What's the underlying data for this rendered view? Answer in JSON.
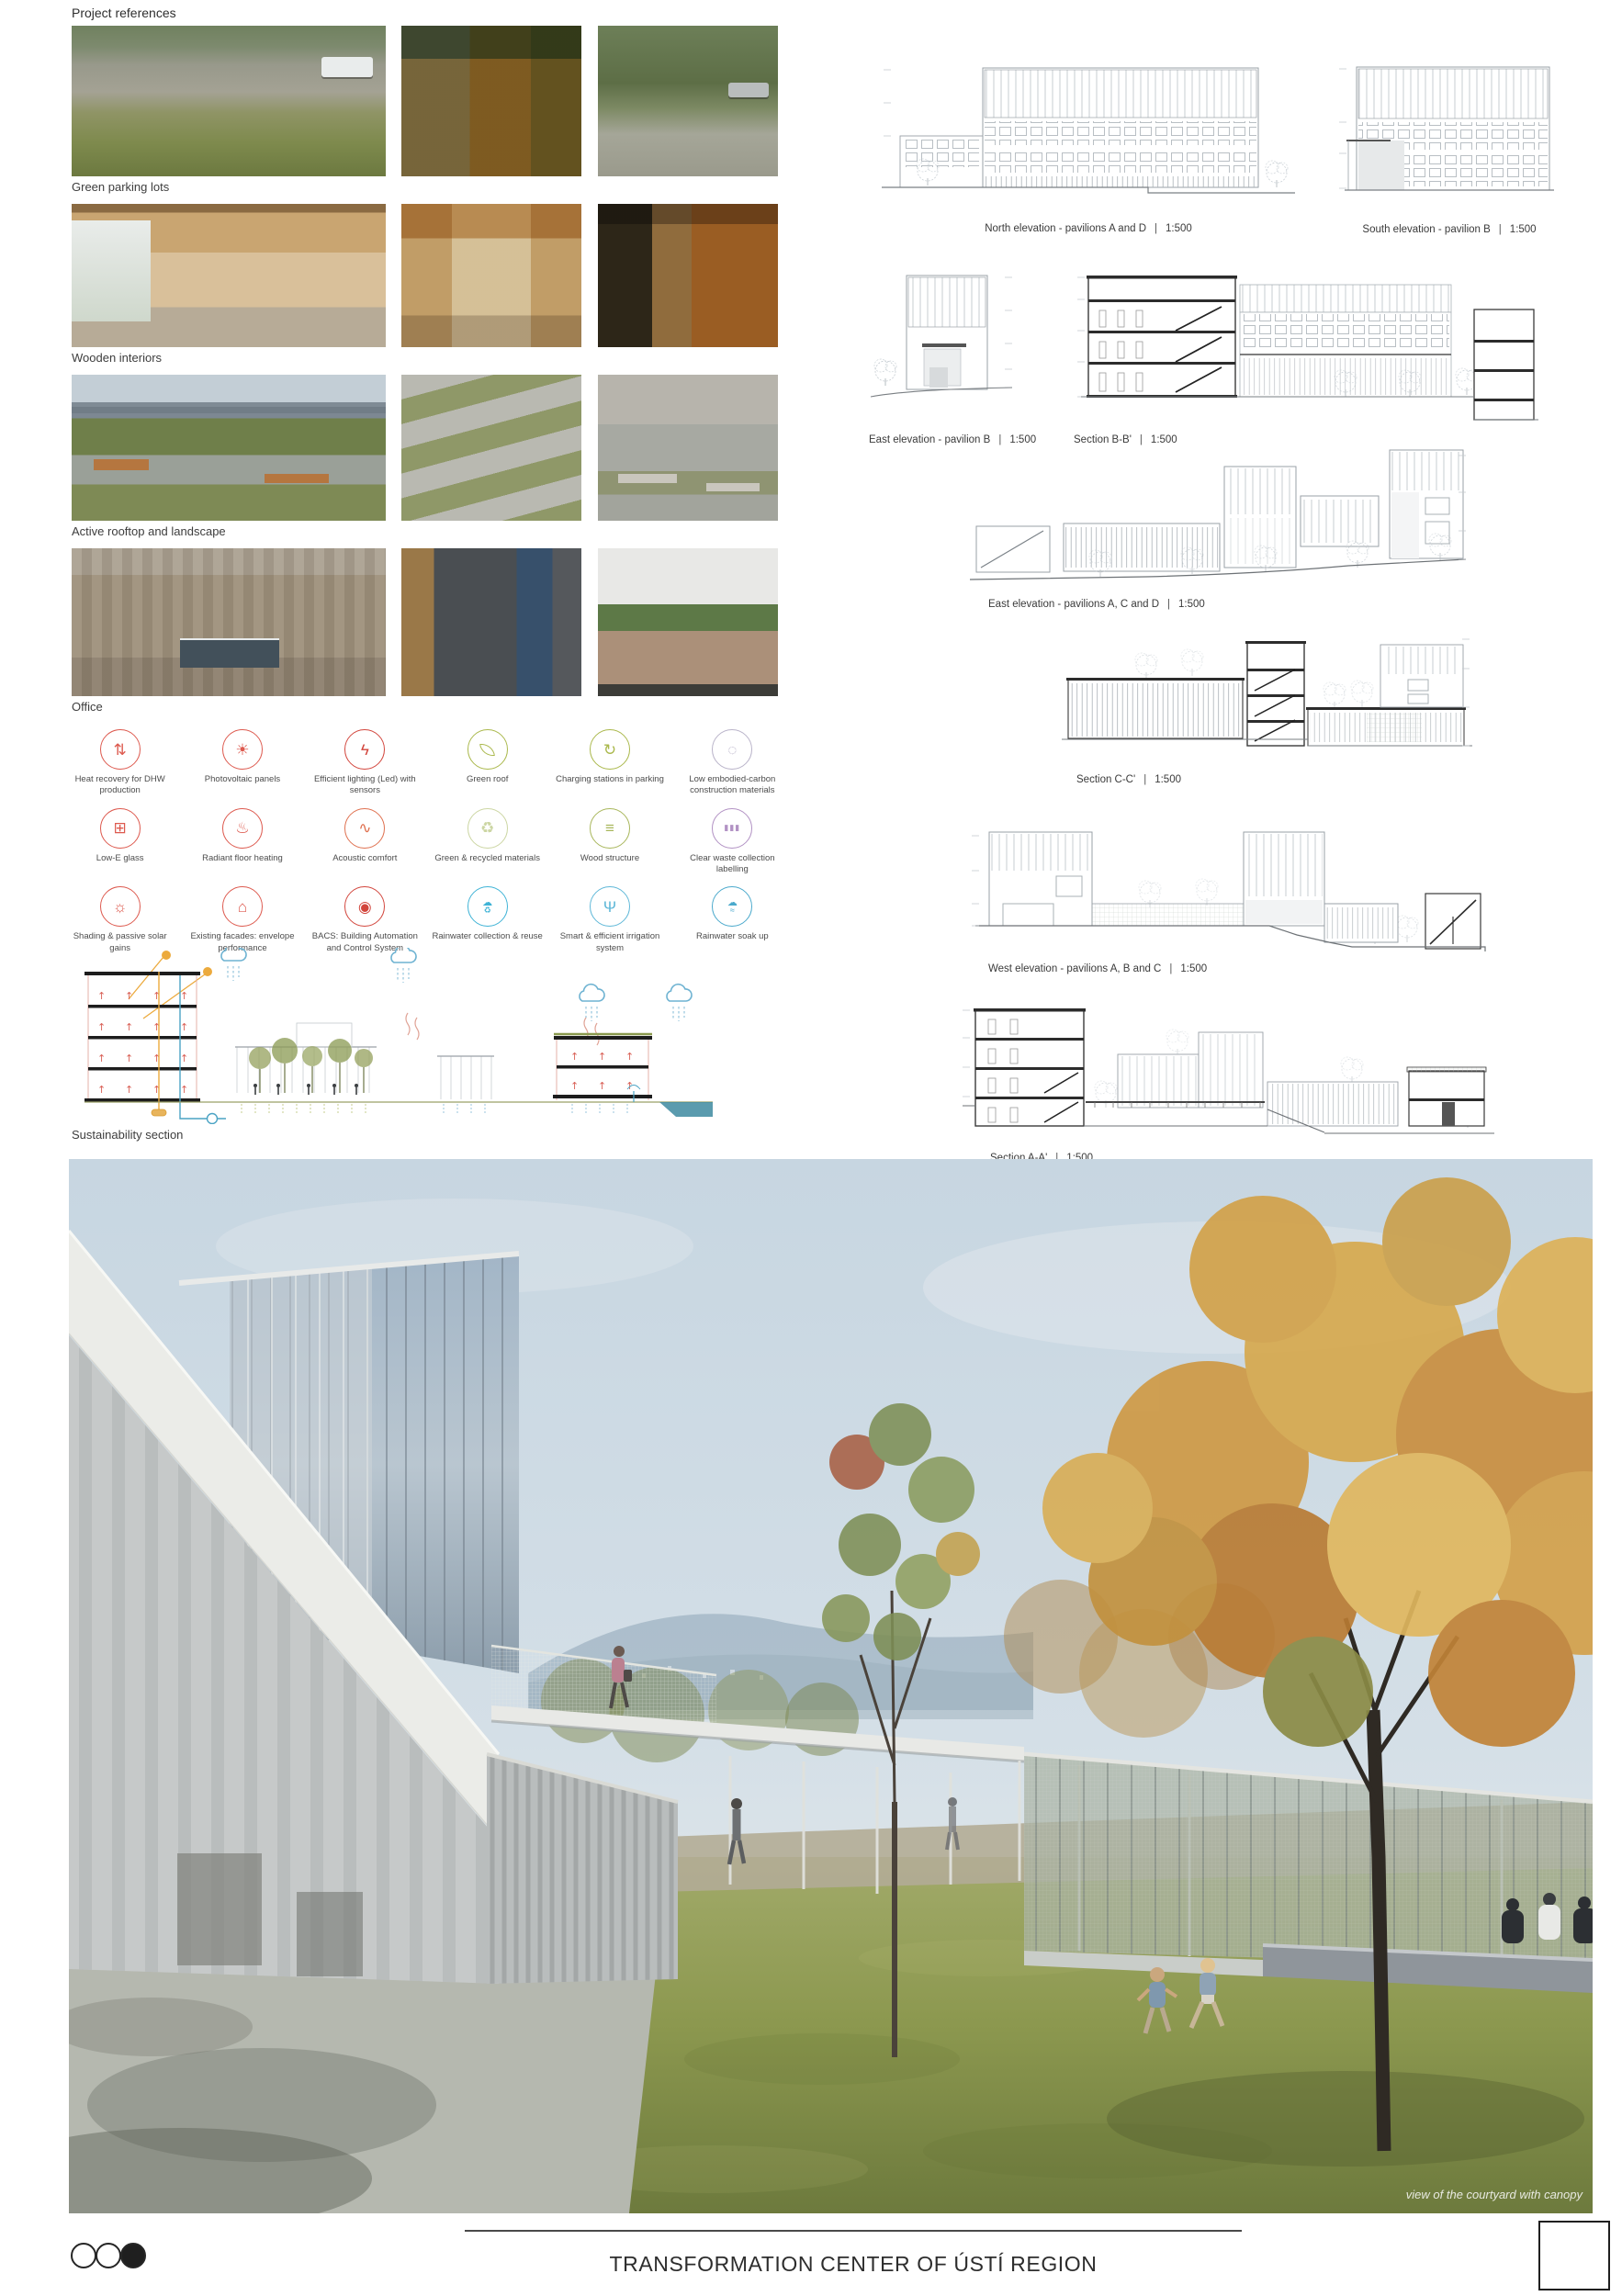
{
  "header": {
    "section_title": "Project references"
  },
  "reference_rows": [
    {
      "caption": "Green parking lots"
    },
    {
      "caption": "Wooden interiors"
    },
    {
      "caption": "Active rooftop and landscape"
    },
    {
      "caption": "Office"
    }
  ],
  "sustainability": {
    "section_label": "Sustainability section",
    "icons": [
      {
        "label": "Heat recovery for DHW production",
        "color": "#dd5a4f"
      },
      {
        "label": "Photovoltaic panels",
        "color": "#dd5a4f"
      },
      {
        "label": "Efficient lighting (Led) with sensors",
        "color": "#d2453c"
      },
      {
        "label": "Green roof",
        "color": "#aab84b"
      },
      {
        "label": "Charging stations in parking",
        "color": "#aab84b"
      },
      {
        "label": "Low embodied-carbon construction materials",
        "color": "#b9b3c9"
      },
      {
        "label": "Low-E glass",
        "color": "#dd5a4f"
      },
      {
        "label": "Radiant floor heating",
        "color": "#dd5a4f"
      },
      {
        "label": "Acoustic comfort",
        "color": "#df7150"
      },
      {
        "label": "Green & recycled materials",
        "color": "#ccd6a3"
      },
      {
        "label": "Wood structure",
        "color": "#a9b75c"
      },
      {
        "label": "Clear waste collection labelling",
        "color": "#b292c4"
      },
      {
        "label": "Shading & passive solar gains",
        "color": "#dd5a4f"
      },
      {
        "label": "Existing facades: envelope performance",
        "color": "#dd5a4f"
      },
      {
        "label": "BACS: Building Automation and Control System",
        "color": "#d2453c"
      },
      {
        "label": "Rainwater collection & reuse",
        "color": "#3fb3d6"
      },
      {
        "label": "Smart & efficient irrigation system",
        "color": "#5fb8d8"
      },
      {
        "label": "Rainwater soak up",
        "color": "#4aa9cc"
      }
    ]
  },
  "separator": "|",
  "drawings": [
    {
      "caption": "North elevation - pavilions A and D",
      "scale": "1:500"
    },
    {
      "caption": "South elevation - pavilion B",
      "scale": "1:500"
    },
    {
      "caption": "East elevation - pavilion B",
      "scale": "1:500"
    },
    {
      "caption": "Section B-B'",
      "scale": "1:500"
    },
    {
      "caption": "East elevation - pavilions A, C and D",
      "scale": "1:500"
    },
    {
      "caption": "Section C-C'",
      "scale": "1:500"
    },
    {
      "caption": "West elevation - pavilions A, B and C",
      "scale": "1:500"
    },
    {
      "caption": "Section A-A'",
      "scale": "1:500"
    }
  ],
  "rendering": {
    "caption": "view of the courtyard with canopy"
  },
  "footer": {
    "title": "TRANSFORMATION CENTER OF ÚSTÍ REGION"
  }
}
